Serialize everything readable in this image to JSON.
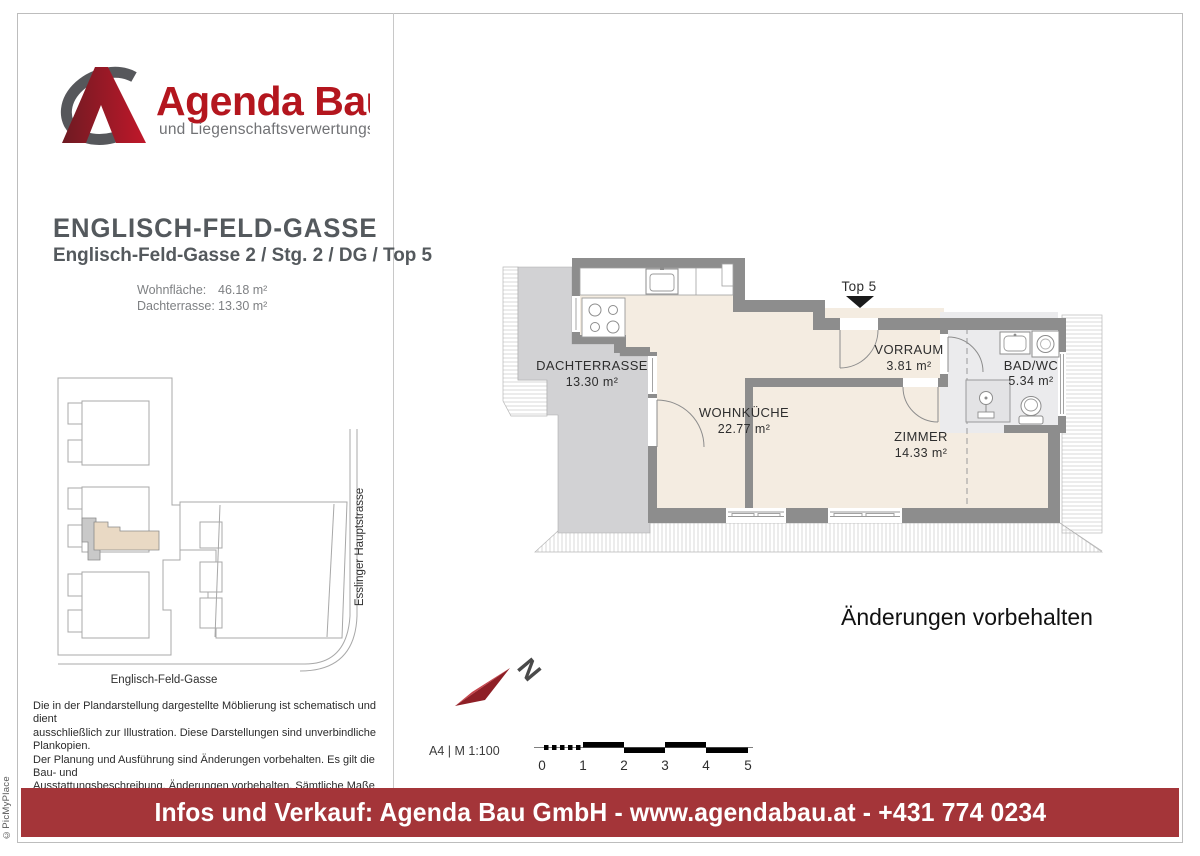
{
  "logo": {
    "title": "Agenda Bau",
    "subtitle": "und Liegenschaftsverwertungs GmbH"
  },
  "project": {
    "title": "ENGLISCH-FELD-GASSE",
    "subtitle": "Englisch-Feld-Gasse 2 / Stg. 2 / DG / Top 5",
    "areas": [
      {
        "label": "Wohnfläche:",
        "value": "46.18 m²"
      },
      {
        "label": "Dachterrasse:",
        "value": "13.30 m²"
      }
    ]
  },
  "site_plan": {
    "street_bottom": "Englisch-Feld-Gasse",
    "street_right": "Esslinger Hauptstrasse"
  },
  "floor_plan": {
    "unit_label": "Top 5",
    "rooms": [
      {
        "name": "DACHTERRASSE",
        "area": "13.30 m²"
      },
      {
        "name": "WOHNKÜCHE",
        "area": "22.77 m²"
      },
      {
        "name": "VORRAUM",
        "area": "3.81 m²"
      },
      {
        "name": "BAD/WC",
        "area": "5.34 m²"
      },
      {
        "name": "ZIMMER",
        "area": "14.33 m²"
      }
    ]
  },
  "note": "Änderungen vorbehalten",
  "north_label": "N",
  "scale": {
    "label": "A4 | M 1:100",
    "ticks": [
      "0",
      "1",
      "2",
      "3",
      "4",
      "5"
    ]
  },
  "disclaimer": [
    "Die in der Plandarstellung dargestellte Möblierung ist schematisch und dient",
    "ausschließlich zur Illustration. Diese Darstellungen sind unverbindliche Plankopien.",
    "Der Planung und Ausführung sind Änderungen vorbehalten. Es gilt die Bau- und",
    "Ausstattungsbeschreibung. Änderungen vorbehalten. Sämtliche Maße",
    "entsprechen dem Planstand Wohnungsdetailsplan."
  ],
  "footer": {
    "text": "Infos und Verkauf: Agenda Bau GmbH - www.agendabau.at - +431 774 0234"
  },
  "credit": "©PicMyPlace",
  "colors": {
    "brand_red": "#b4161e",
    "footer_red": "#a43539",
    "wall_gray": "#8d8d8d",
    "room_beige": "#f4ece1",
    "terrace_gray": "#d2d2d4",
    "bath_gray": "#ebebed"
  }
}
